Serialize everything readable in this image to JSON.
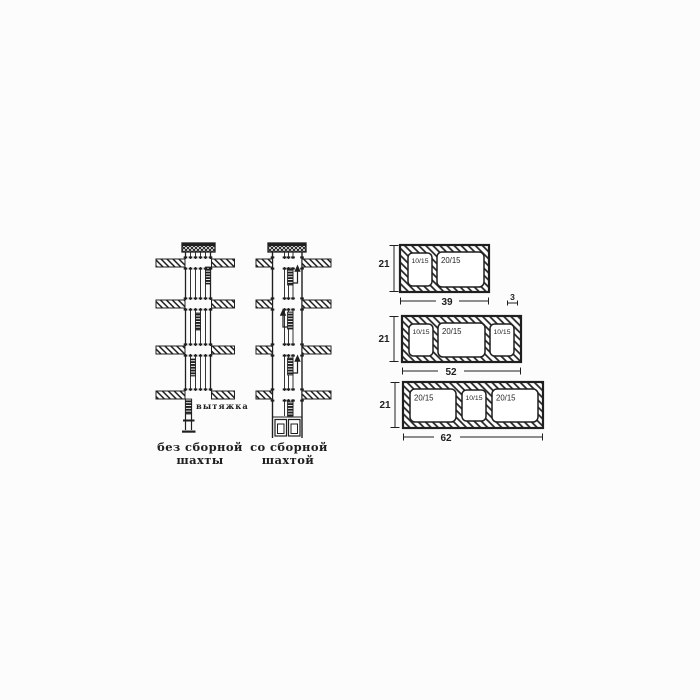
{
  "figure": {
    "background": "#fcfcfc",
    "ink": "#1f1f1f",
    "shafts": {
      "exhaust_label": "вытяжка",
      "without_collector": {
        "caption_line1": "без сборной",
        "caption_line2": "шахты"
      },
      "with_collector": {
        "caption_line1": "со сборной",
        "caption_line2": "шахтой"
      }
    },
    "blocks": [
      {
        "height_label": "21",
        "width_label": "39",
        "wall_thickness_label": "3",
        "openings": [
          {
            "label": "10/15"
          },
          {
            "label": "20/15"
          }
        ]
      },
      {
        "height_label": "21",
        "width_label": "52",
        "openings": [
          {
            "label": "10/15"
          },
          {
            "label": "20/15"
          },
          {
            "label": "10/15"
          }
        ]
      },
      {
        "height_label": "21",
        "width_label": "62",
        "openings": [
          {
            "label": "20/15"
          },
          {
            "label": "10/15"
          },
          {
            "label": "20/15"
          }
        ]
      }
    ]
  }
}
